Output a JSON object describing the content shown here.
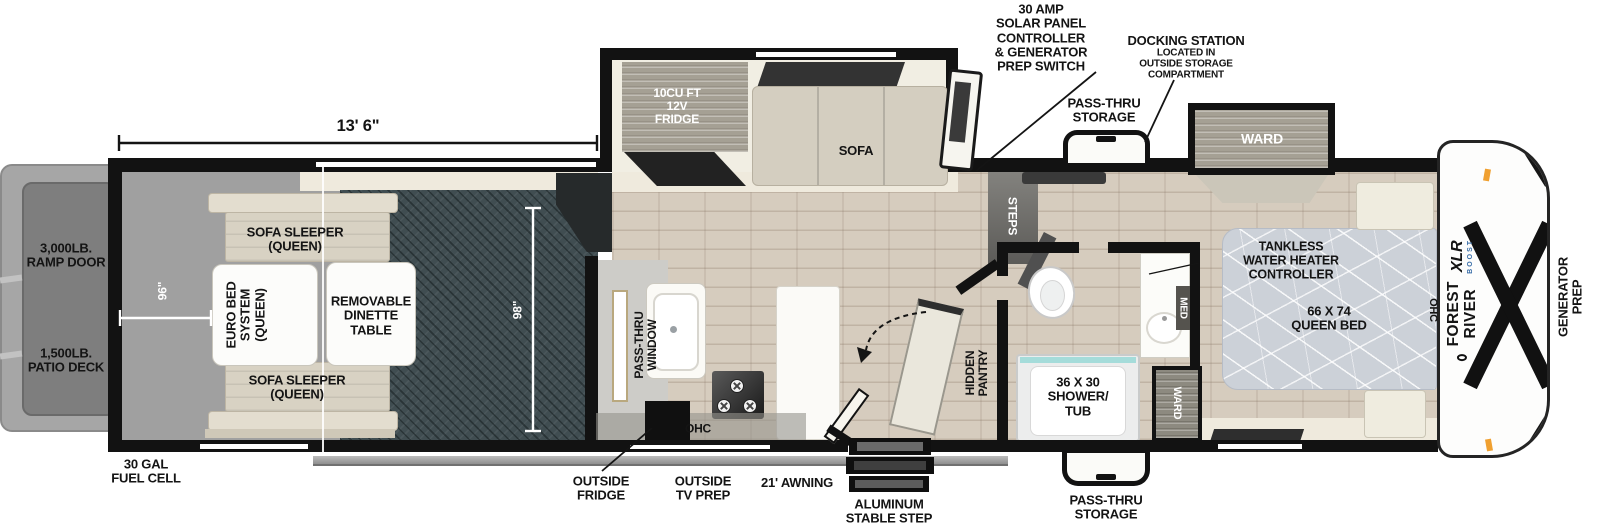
{
  "colors": {
    "wall": "#121212",
    "garage_floor": "#404d51",
    "wood_floor": "#d6ccbe",
    "shower_glass": "#a5dcda",
    "marker_light": "#f0a030"
  },
  "dimensions": {
    "garage_length": "13' 6\"",
    "ramp_width": "96\"",
    "garage_depth": "98\""
  },
  "callouts": {
    "solar": "30 AMP\nSOLAR PANEL\nCONTROLLER\n& GENERATOR\nPREP SWITCH",
    "docking_title": "DOCKING STATION",
    "docking_sub": "LOCATED IN\nOUTSIDE STORAGE\nCOMPARTMENT",
    "passthru_top": "PASS-THRU\nSTORAGE",
    "passthru_bottom": "PASS-THRU\nSTORAGE",
    "outside_fridge": "OUTSIDE\nFRIDGE",
    "outside_tv": "OUTSIDE\nTV PREP",
    "awning": "21' AWNING",
    "stable_step": "ALUMINUM\nSTABLE STEP",
    "fuel_cell": "30 GAL\nFUEL CELL",
    "ramp_door": "3,000LB.\nRAMP DOOR",
    "patio_deck": "1,500LB.\nPATIO DECK",
    "generator_prep": "GENERATOR\nPREP"
  },
  "garage": {
    "sofa_top": "SOFA SLEEPER\n(QUEEN)",
    "sofa_bottom": "SOFA SLEEPER\n(QUEEN)",
    "euro_bed": "EURO BED\nSYSTEM\n(QUEEN)",
    "dinette": "REMOVABLE\nDINETTE\nTABLE"
  },
  "kitchen": {
    "fridge": "10CU FT\n12V\nFRIDGE",
    "sofa": "SOFA",
    "pass_thru_window": "PASS-THRU\nWINDOW",
    "ohc": "OHC",
    "steps": "STEPS",
    "hidden_pantry": "HIDDEN\nPANTRY"
  },
  "bath": {
    "shower": "36 X 30\nSHOWER/\nTUB",
    "med": "MED",
    "ward": "WARD"
  },
  "bedroom": {
    "ward_slide": "WARD",
    "tankless": "TANKLESS\nWATER HEATER\nCONTROLLER",
    "bed": "66 X 74\nQUEEN BED",
    "ohc": "OHC"
  },
  "brand": {
    "maker": "FOREST RIVER",
    "model": "XLR",
    "sub": "BOOST"
  }
}
